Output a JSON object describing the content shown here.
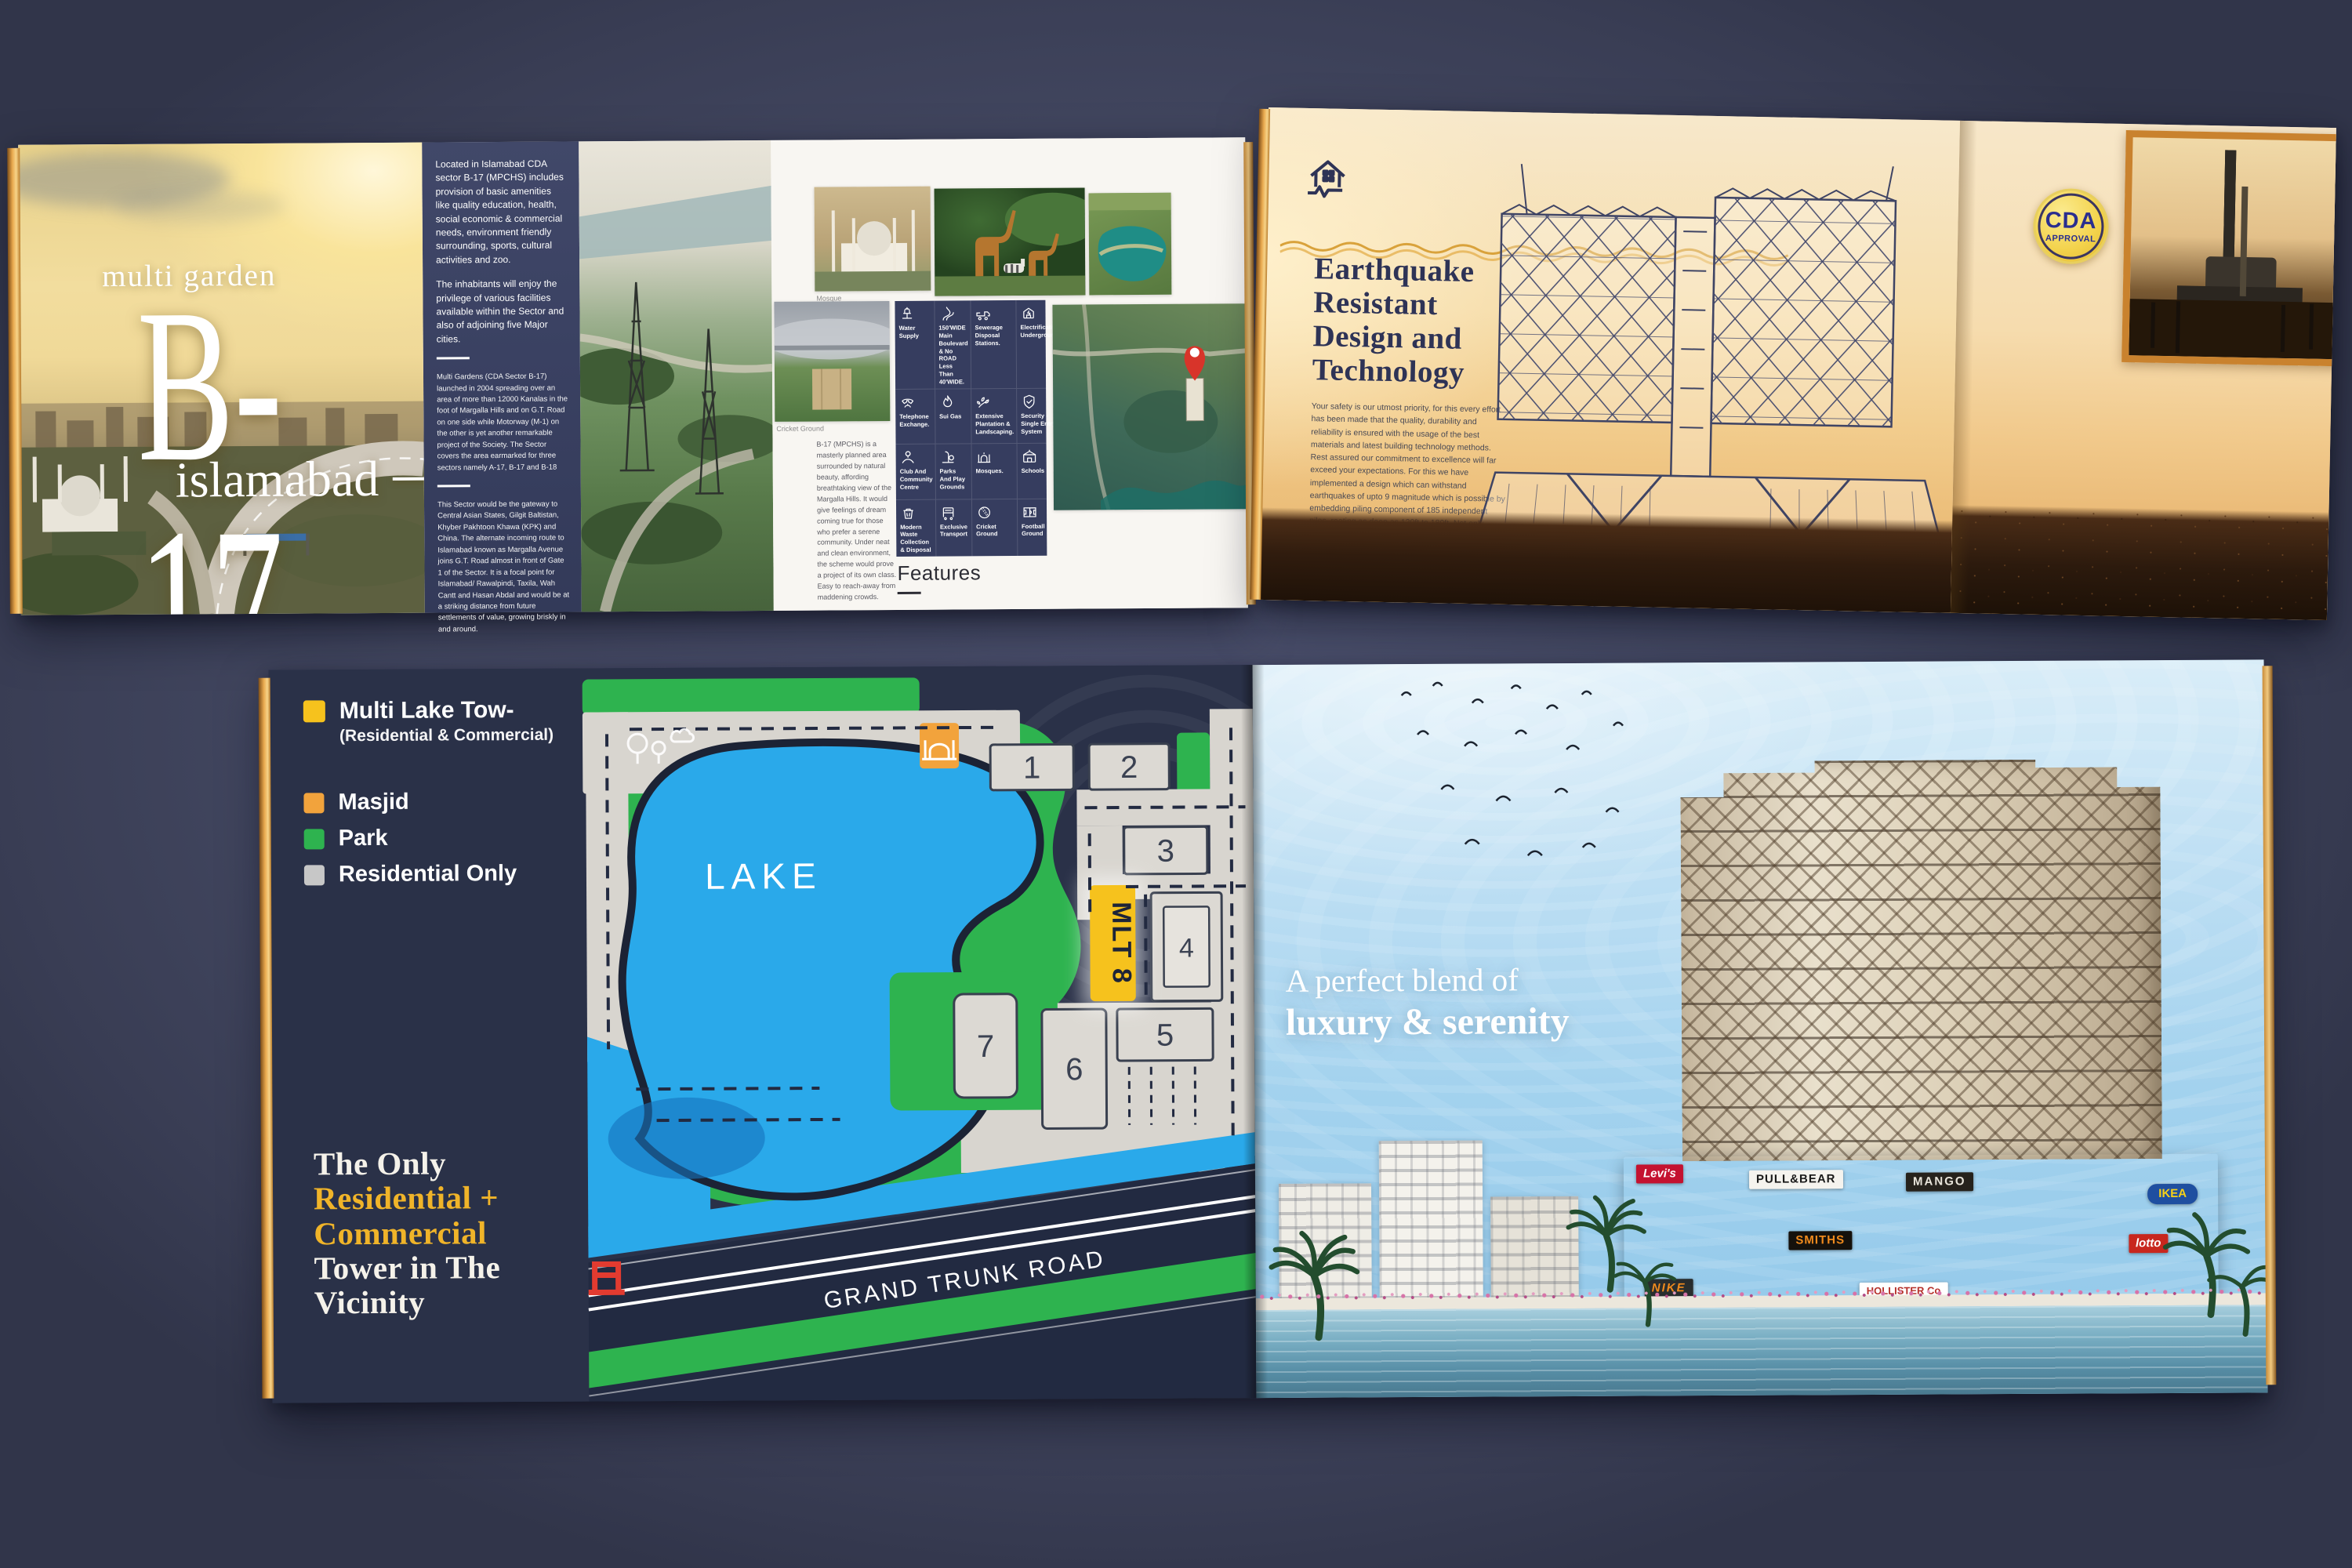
{
  "palette": {
    "desk": "#474c66",
    "accent_gold": "#f0b429",
    "map_navy": "#2a3148",
    "map_green": "#2eb34f",
    "lake_blue": "#2aa9ea",
    "tower_yellow": "#f6c21d",
    "masjid_orange": "#f2a33c",
    "residential_gray": "#c7c7c7",
    "heading_navy": "#2e3356",
    "badge_yellow": "#f3d24b",
    "badge_blue": "#2a2e8f"
  },
  "spread1": {
    "cover": {
      "kicker": "multi garden",
      "title": "B-17",
      "subtitle": "islamabad"
    },
    "intro": {
      "p1": "Located in Islamabad CDA sector B-17 (MPCHS) includes provision of basic amenities like quality education, health, social economic & commercial needs, environment friendly surrounding, sports, cultural activities and zoo.",
      "p2": "The inhabitants will enjoy the privilege of various facilities available within the Sector and also of adjoining five Major cities.",
      "p3": "Multi Gardens (CDA Sector B-17) launched in 2004 spreading over an area of more than 12000 Kanalas in the foot of Margalla Hills and on G.T. Road on one side while Motorway (M-1) on the other is yet another remarkable project of the Society. The Sector covers the area earmarked for three sectors namely A-17, B-17 and B-18",
      "p4": "This Sector would be the gateway to Central Asian States, Gilgit Baltistan, Khyber Pakhtoon Khawa (KPK) and China. The alternate incoming route to Islamabad known as Margalla Avenue joins G.T. Road almost in front of Gate 1 of the Sector. It is a focal point for Islamabad/ Rawalpindi, Taxila, Wah Cantt and Hasan Abdal and would be at a striking distance from future settlements of value, growing briskly in and around."
    },
    "about": "B-17 (MPCHS) is a masterly planned area surrounded by natural beauty, affording breathtaking view of the Margalla Hills. It would give feelings of dream coming true for those who prefer a serene community. Under neat and clean environment, the scheme would prove a project of its own class. Easy to reach-away from maddening crowds.",
    "captions": {
      "mosque": "Mosque",
      "cricket": "Cricket Ground"
    },
    "features_heading": "Features",
    "features": [
      "Water Supply",
      "150'WIDE Main Boulevard & No ROAD Less Than 40'WIDE.",
      "Sewerage Disposal Stations.",
      "Electrification Underground.",
      "Telephone Exchange.",
      "Sui Gas",
      "Extensive Plantation & Landscaping.",
      "Security - Single Entry System",
      "Club And Community Centre",
      "Parks And Play Grounds",
      "Mosques.",
      "Schools",
      "Modern Waste Collection & Disposal",
      "Exclusive Transport",
      "Cricket Ground",
      "Football Ground"
    ]
  },
  "spread2": {
    "heading": {
      "line1": "Earthquake",
      "line2": "Resistant",
      "line3": "Design and",
      "line4": "Technology"
    },
    "body": "Your safety is our utmost priority, for this every effort has been made that the quality, durability and reliability is ensured with the usage of the best materials and latest building technology methods. Rest assured our commitment to excellence will far exceed your expectations. For this we have implemented a design which can withstand earthquakes of upto 9 magnitude which is possible by embedding piling component of 185 independent piles, rooting as deep as 120ft to 180ft. Not only keeping the building and your family safe, but overall extending the lifespan of the building extensively.",
    "badge": {
      "line1": "CDA",
      "line2": "APPROVAL"
    }
  },
  "spread3": {
    "legend": {
      "primary": {
        "label": "Multi Lake Tow-",
        "sub": "(Residential & Commercial)"
      },
      "items": [
        {
          "label": "Masjid"
        },
        {
          "label": "Park"
        },
        {
          "label": "Residential Only"
        }
      ]
    },
    "map": {
      "lake_label": "LAKE",
      "tower_label": "MLT 8",
      "road_label": "GRAND TRUNK ROAD",
      "plots": [
        "1",
        "2",
        "3",
        "4",
        "5",
        "6",
        "7"
      ]
    },
    "tagline": {
      "line1": "The Only",
      "line2": "Residential +",
      "line3": "Commercial",
      "line4": "Tower in The",
      "line5": "Vicinity"
    },
    "hero": {
      "line1": "A perfect blend of",
      "line2": "luxury & serenity"
    },
    "signs": [
      "Levi's",
      "PULL&BEAR",
      "MANGO",
      "SMITHS",
      "HOLLISTER Co",
      "NIKE",
      "IKEA",
      "lotto"
    ]
  }
}
